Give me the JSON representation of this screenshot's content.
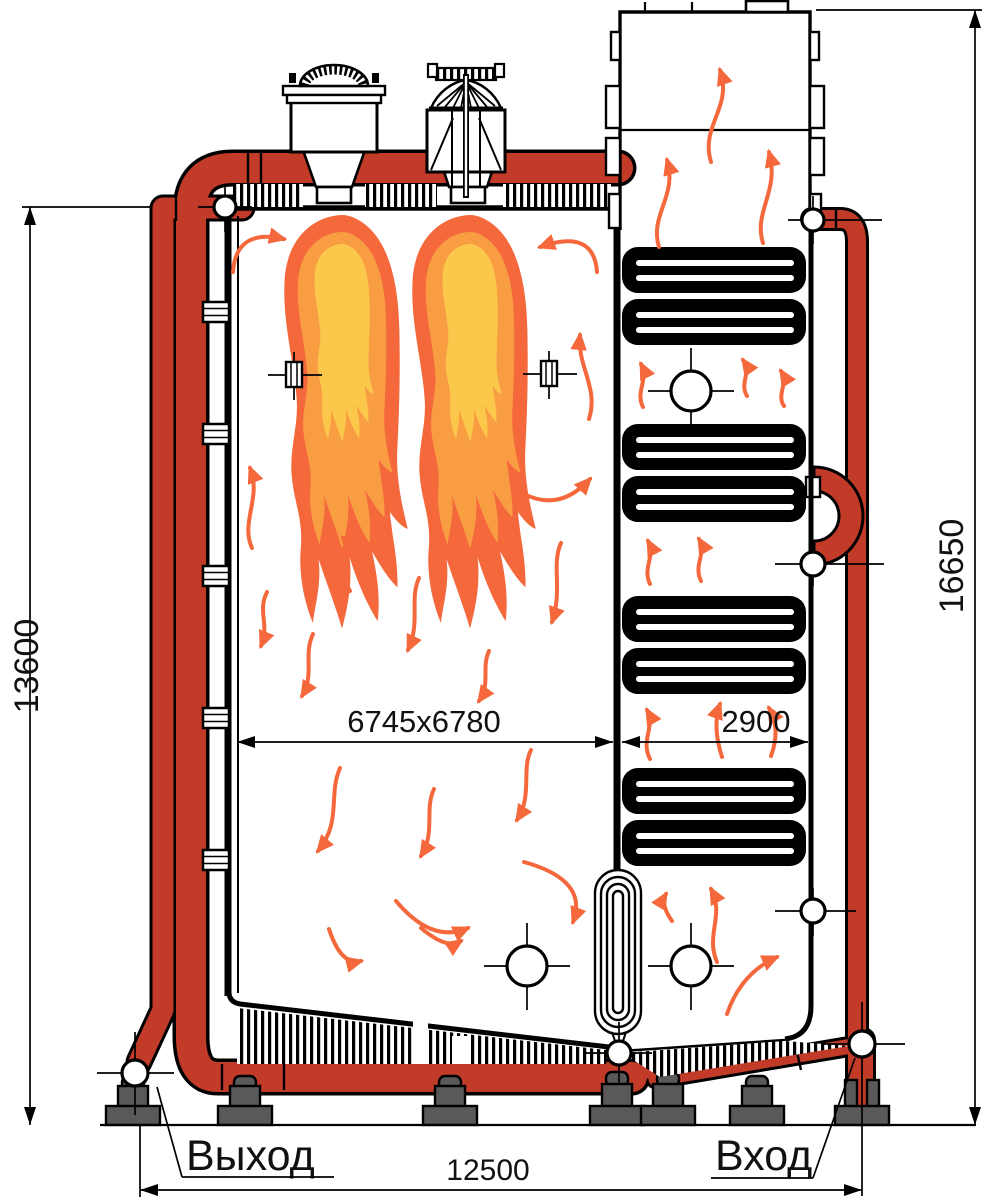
{
  "diagram": {
    "type": "boiler-sectional-technical-drawing",
    "labels": {
      "outlet": "Выход",
      "inlet": "Вход"
    },
    "dimensions": {
      "left_height": "13600",
      "right_height": "16650",
      "furnace_width": "6745x6780",
      "gas_duct_width": "2900",
      "base_width": "12500"
    },
    "symbols": {
      "crosshair_marker": "pipe-connection-crosshair",
      "flow_arrow": "gas-flow-arrow",
      "flame": "burner-flame"
    },
    "colors": {
      "pipe_red": "#c23a28",
      "flame_outer": "#f4683c",
      "flame_mid": "#f89d42",
      "flame_core": "#fcc84c",
      "arrow_orange": "#f4683c",
      "support_gray": "#595959",
      "line_black": "#000000"
    }
  }
}
